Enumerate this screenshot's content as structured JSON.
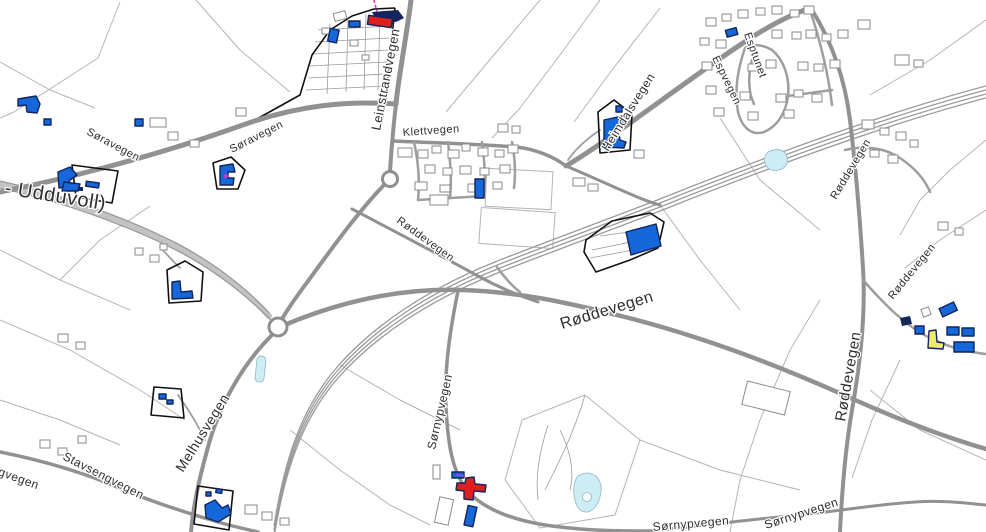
{
  "map": {
    "description": "Norwegian road and cadastral map, Leinstrand / Melhus area",
    "background": "#ffffff",
    "colors": {
      "road": "#919191",
      "road_minor": "#9e9e9e",
      "field_line": "#b5b5b5",
      "building_gray_stroke": "#8a8a8a",
      "building_blue": "#1667d9",
      "building_navy": "#12255c",
      "building_red": "#df1f1f",
      "building_yellow": "#efec67",
      "water_fill": "#cdecf6",
      "water_stroke": "#8fb9c9",
      "parcel_black": "#111111",
      "label": "#2e2e2e",
      "magenta": "#cc33cc"
    },
    "road_labels": [
      {
        "text": "Søravegen",
        "x": 86,
        "y": 134,
        "rotation": 28,
        "size": 11
      },
      {
        "text": "Søravegen",
        "x": 232,
        "y": 153,
        "rotation": -27,
        "size": 11
      },
      {
        "text": "- Udduvoll)",
        "x": 4,
        "y": 194,
        "rotation": 9,
        "size": 20
      },
      {
        "text": "Leinstrandvegen",
        "x": 380,
        "y": 131,
        "rotation": -79,
        "size": 13
      },
      {
        "text": "Klettvegen",
        "x": 403,
        "y": 136,
        "rotation": -4,
        "size": 11
      },
      {
        "text": "Heimdalsvegen",
        "x": 608,
        "y": 152,
        "rotation": -58,
        "size": 12
      },
      {
        "text": "Esptunet",
        "x": 744,
        "y": 34,
        "rotation": 70,
        "size": 11
      },
      {
        "text": "Espvegen",
        "x": 712,
        "y": 58,
        "rotation": 64,
        "size": 11
      },
      {
        "text": "Røddevegen",
        "x": 396,
        "y": 222,
        "rotation": 36,
        "size": 11
      },
      {
        "text": "Røddevegen",
        "x": 562,
        "y": 329,
        "rotation": -17,
        "size": 16
      },
      {
        "text": "Røddevegen",
        "x": 836,
        "y": 200,
        "rotation": -59,
        "size": 11
      },
      {
        "text": "Røddevegen",
        "x": 893,
        "y": 300,
        "rotation": -51,
        "size": 11
      },
      {
        "text": "Røddevegen",
        "x": 845,
        "y": 422,
        "rotation": -80,
        "size": 15
      },
      {
        "text": "Melhusvegen",
        "x": 183,
        "y": 473,
        "rotation": -58,
        "size": 14
      },
      {
        "text": "Stavsengvegen",
        "x": 62,
        "y": 459,
        "rotation": 27,
        "size": 12
      },
      {
        "text": "engvegen",
        "x": -16,
        "y": 470,
        "rotation": 20,
        "size": 12
      },
      {
        "text": "Sørnypvegen",
        "x": 435,
        "y": 450,
        "rotation": -77,
        "size": 12
      },
      {
        "text": "Sørnypvegen",
        "x": 653,
        "y": 531,
        "rotation": -5,
        "size": 12
      },
      {
        "text": "Sørnypvegen",
        "x": 766,
        "y": 529,
        "rotation": -18,
        "size": 12
      }
    ]
  }
}
